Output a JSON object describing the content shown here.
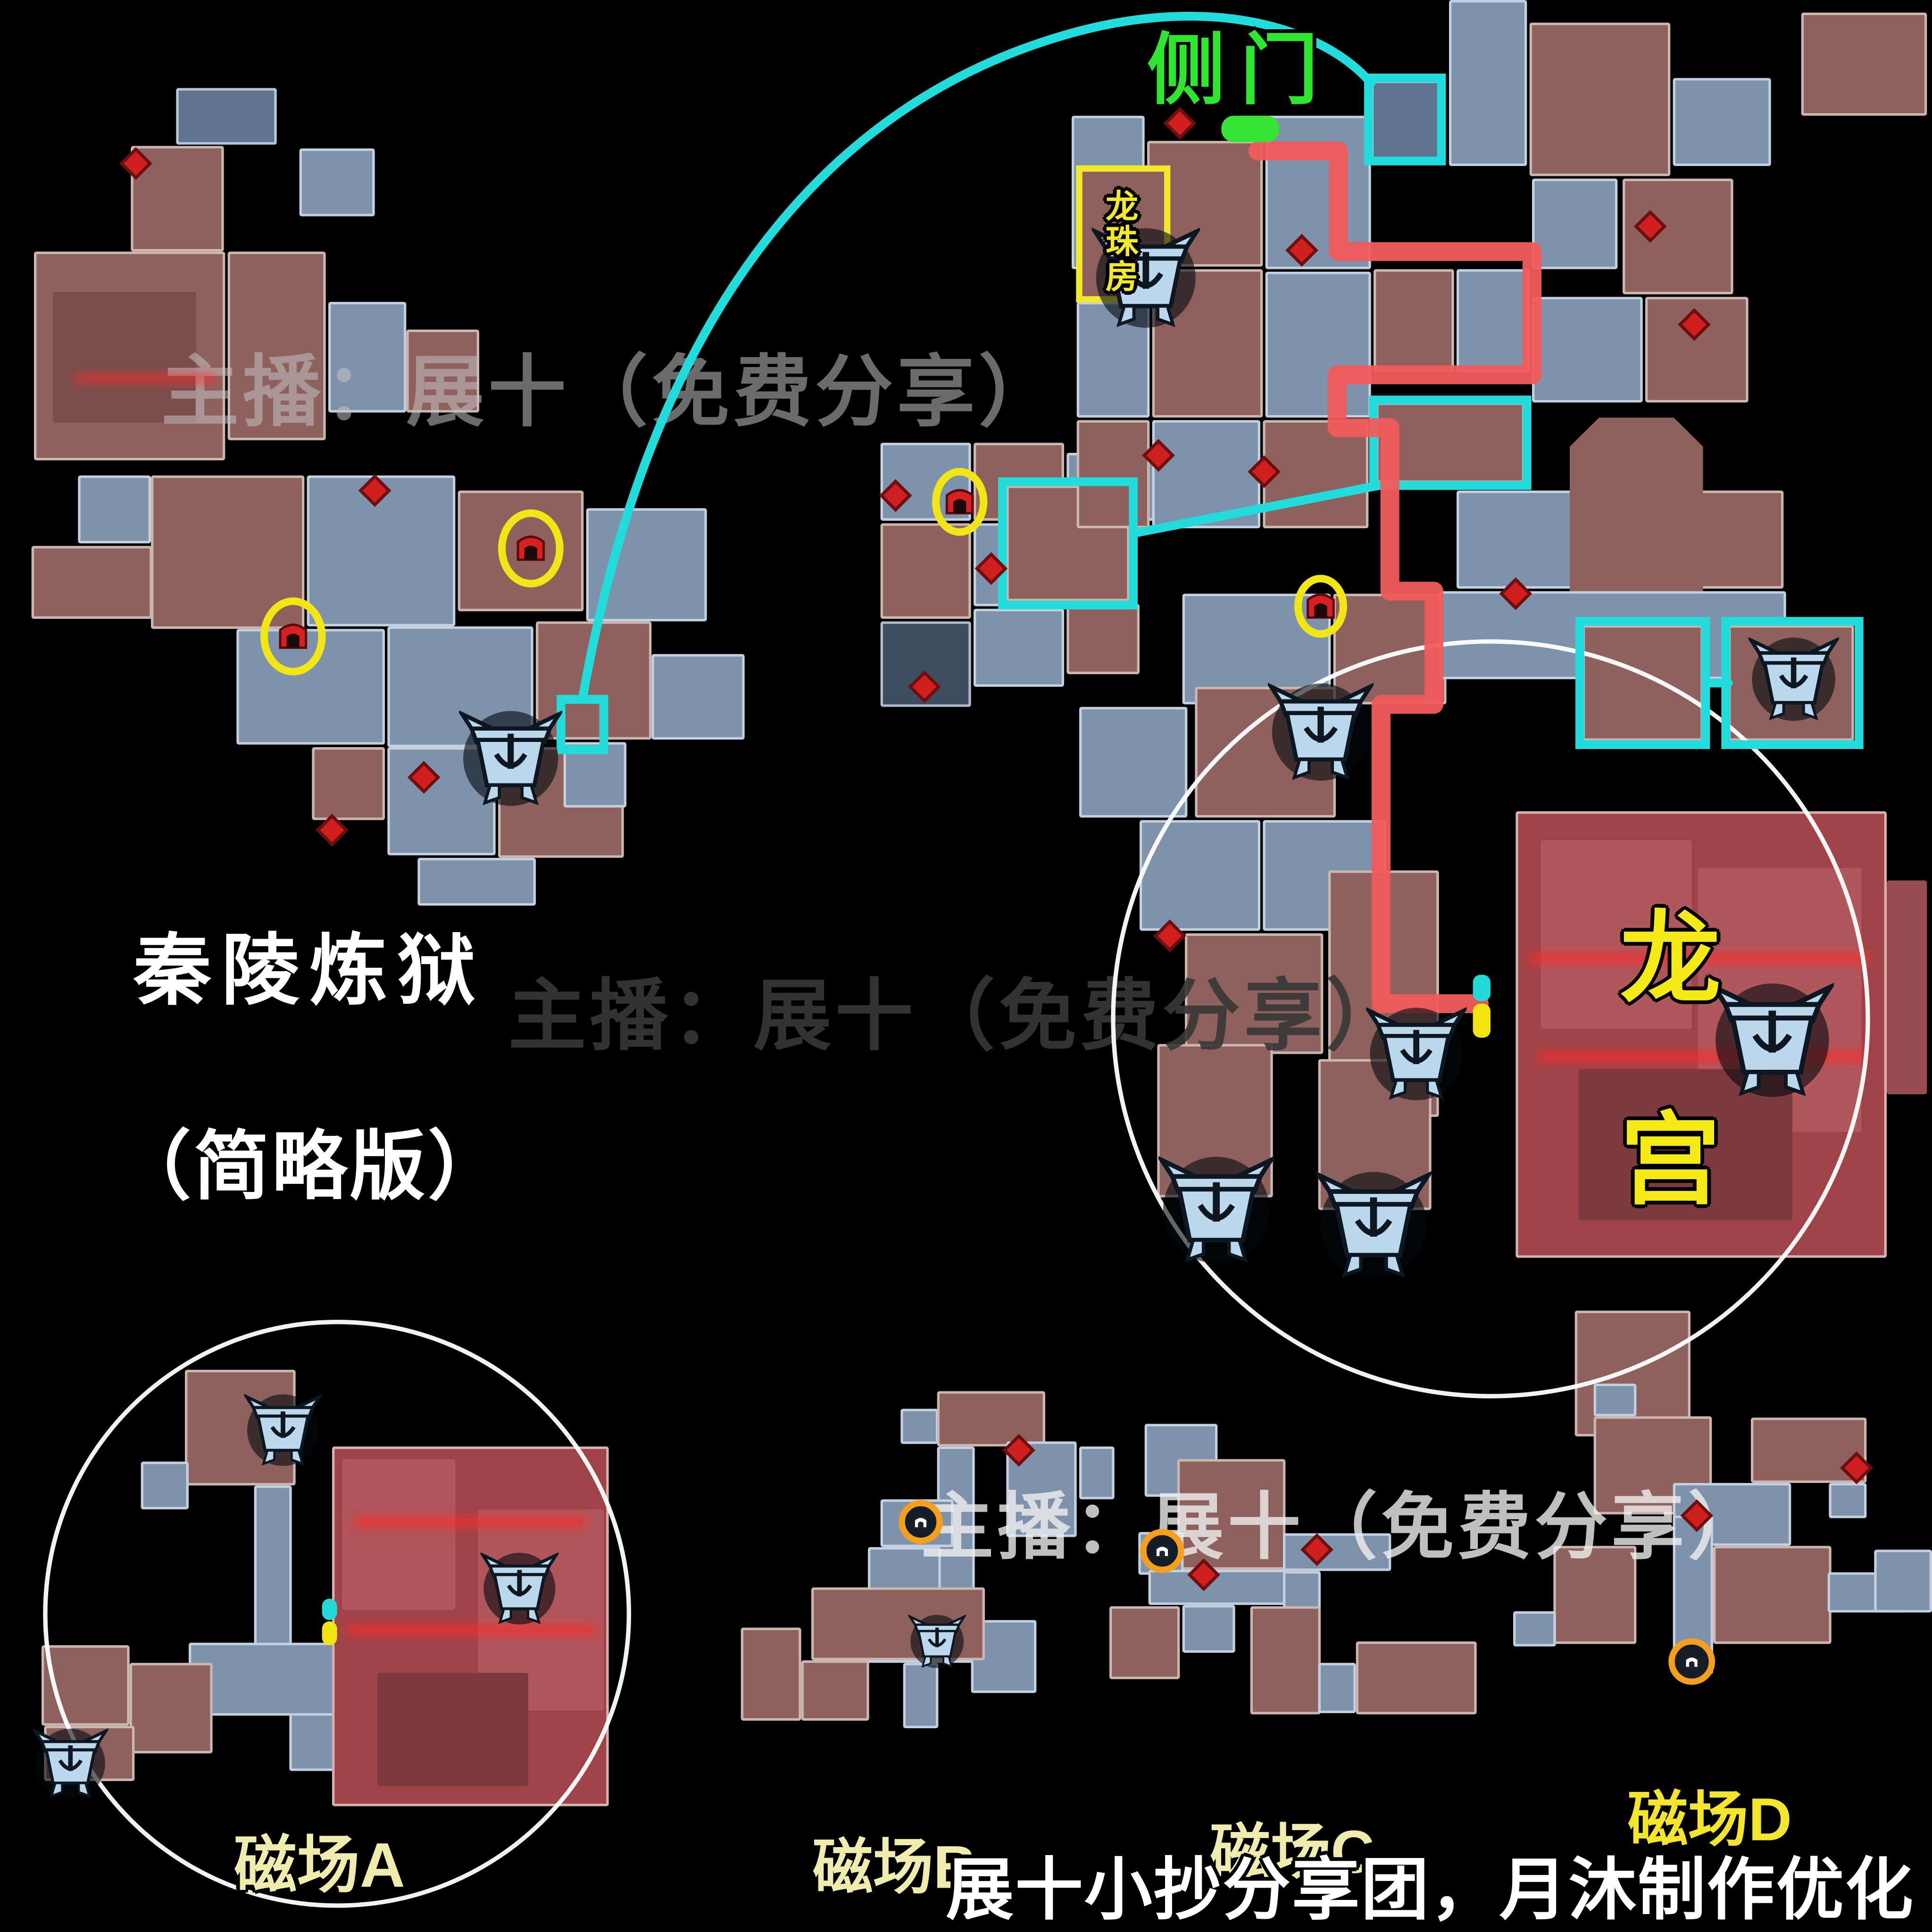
{
  "texts": {
    "watermark": "主播：展十（免费分享）",
    "side_door": "侧门",
    "pearl_room": [
      "龙",
      "珠",
      "房"
    ],
    "palace": [
      "龙",
      "宫"
    ],
    "title_line1": "秦陵炼狱",
    "title_line2": "（简略版）",
    "field_a": "磁场A",
    "field_b": "磁场B",
    "field_c": "磁场C",
    "field_d": "磁场D",
    "credit": "展十小抄分享团，月沐制作优化"
  },
  "colors": {
    "background": "#000000",
    "room_blue": "#7e92ac",
    "room_blue_dark": "#5f7490",
    "room_navy": "#3d4c60",
    "room_maroon": "#8e615f",
    "room_red": "#9e4449",
    "route_red": "#f15b5b",
    "cyan": "#22dcdc",
    "yellow": "#f2e616",
    "green": "#35e435",
    "orange": "#f59f1c",
    "label_cream": "#f0ecae",
    "label_yellow": "#f3e52c",
    "chest_fill": "#bcd8ec",
    "diamond_red": "#cf1f1f",
    "white": "#ffffff"
  },
  "map": {
    "rooms": [
      [
        140,
        70,
        80,
        45,
        "d"
      ],
      [
        104,
        116,
        74,
        84,
        "m"
      ],
      [
        238,
        118,
        60,
        54,
        "b"
      ],
      [
        27,
        200,
        152,
        166,
        "m"
      ],
      [
        42,
        232,
        114,
        104,
        "m2"
      ],
      [
        181,
        200,
        78,
        150,
        "m"
      ],
      [
        261,
        240,
        62,
        88,
        "b"
      ],
      [
        323,
        262,
        58,
        66,
        "m"
      ],
      [
        62,
        378,
        58,
        54,
        "b"
      ],
      [
        25,
        434,
        96,
        58,
        "m"
      ],
      [
        120,
        378,
        122,
        122,
        "m"
      ],
      [
        244,
        378,
        118,
        120,
        "b"
      ],
      [
        364,
        390,
        100,
        96,
        "m"
      ],
      [
        466,
        404,
        96,
        90,
        "b"
      ],
      [
        188,
        500,
        118,
        92,
        "b"
      ],
      [
        308,
        498,
        116,
        96,
        "b"
      ],
      [
        426,
        494,
        92,
        94,
        "m"
      ],
      [
        518,
        520,
        74,
        68,
        "b"
      ],
      [
        248,
        594,
        58,
        58,
        "m"
      ],
      [
        308,
        594,
        86,
        86,
        "b"
      ],
      [
        396,
        594,
        100,
        88,
        "m"
      ],
      [
        448,
        590,
        50,
        52,
        "b"
      ],
      [
        332,
        682,
        94,
        38,
        "b"
      ],
      [
        700,
        352,
        72,
        62,
        "b"
      ],
      [
        774,
        352,
        72,
        62,
        "m"
      ],
      [
        700,
        416,
        72,
        76,
        "m"
      ],
      [
        774,
        416,
        72,
        66,
        "b"
      ],
      [
        848,
        360,
        70,
        54,
        "b"
      ],
      [
        700,
        494,
        72,
        68,
        "k"
      ],
      [
        774,
        484,
        72,
        62,
        "b"
      ],
      [
        848,
        480,
        58,
        56,
        "m"
      ],
      [
        800,
        386,
        98,
        92,
        "m"
      ],
      [
        852,
        92,
        58,
        122,
        "b"
      ],
      [
        912,
        112,
        92,
        100,
        "m"
      ],
      [
        1006,
        92,
        84,
        122,
        "b"
      ],
      [
        1090,
        64,
        58,
        64,
        "d"
      ],
      [
        1152,
        0,
        62,
        132,
        "b"
      ],
      [
        1216,
        18,
        112,
        122,
        "m"
      ],
      [
        1330,
        62,
        78,
        70,
        "b"
      ],
      [
        1432,
        10,
        100,
        82,
        "m"
      ],
      [
        858,
        134,
        70,
        104,
        "m"
      ],
      [
        856,
        240,
        58,
        92,
        "b"
      ],
      [
        916,
        214,
        88,
        118,
        "m"
      ],
      [
        1006,
        216,
        84,
        116,
        "b"
      ],
      [
        1092,
        214,
        64,
        82,
        "m"
      ],
      [
        1158,
        214,
        58,
        82,
        "b"
      ],
      [
        1218,
        142,
        68,
        72,
        "b"
      ],
      [
        1290,
        142,
        88,
        92,
        "m"
      ],
      [
        1218,
        236,
        88,
        84,
        "b"
      ],
      [
        1308,
        236,
        82,
        84,
        "m"
      ],
      [
        1094,
        320,
        118,
        64,
        "m"
      ],
      [
        856,
        334,
        58,
        86,
        "m"
      ],
      [
        916,
        334,
        86,
        86,
        "b"
      ],
      [
        1004,
        334,
        84,
        86,
        "m"
      ],
      [
        1158,
        390,
        92,
        78,
        "b"
      ],
      [
        1300,
        390,
        118,
        78,
        "m"
      ],
      [
        1248,
        332,
        106,
        210,
        "m",
        "oct"
      ],
      [
        940,
        472,
        118,
        88,
        "b"
      ],
      [
        1060,
        472,
        90,
        88,
        "m"
      ],
      [
        1144,
        470,
        276,
        70,
        "b"
      ],
      [
        1258,
        497,
        96,
        92,
        "m"
      ],
      [
        1374,
        497,
        100,
        92,
        "m"
      ],
      [
        858,
        562,
        86,
        88,
        "b"
      ],
      [
        950,
        546,
        112,
        104,
        "m"
      ],
      [
        906,
        652,
        96,
        88,
        "b"
      ],
      [
        1004,
        652,
        98,
        88,
        "b"
      ],
      [
        942,
        742,
        110,
        96,
        "m"
      ],
      [
        1056,
        692,
        88,
        196,
        "m"
      ],
      [
        920,
        830,
        92,
        122,
        "m"
      ],
      [
        1048,
        842,
        90,
        120,
        "m"
      ],
      [
        1205,
        645,
        295,
        355,
        "r"
      ],
      [
        1225,
        668,
        120,
        150,
        "r2"
      ],
      [
        1350,
        690,
        130,
        210,
        "r2"
      ],
      [
        1255,
        850,
        170,
        120,
        "r3"
      ],
      [
        1500,
        700,
        32,
        170,
        "r2"
      ],
      [
        1252,
        1042,
        92,
        100,
        "m"
      ],
      [
        147,
        1089,
        88,
        92,
        "m"
      ],
      [
        112,
        1162,
        38,
        38,
        "b"
      ],
      [
        202,
        1181,
        30,
        128,
        "b"
      ],
      [
        150,
        1306,
        120,
        58,
        "b"
      ],
      [
        230,
        1362,
        62,
        46,
        "b"
      ],
      [
        33,
        1308,
        70,
        64,
        "m"
      ],
      [
        103,
        1322,
        66,
        72,
        "m"
      ],
      [
        35,
        1372,
        72,
        44,
        "m"
      ],
      [
        264,
        1150,
        220,
        286,
        "r"
      ],
      [
        272,
        1160,
        90,
        120,
        "r2"
      ],
      [
        380,
        1200,
        100,
        160,
        "r2"
      ],
      [
        300,
        1330,
        120,
        90,
        "r3"
      ],
      [
        716,
        1120,
        30,
        28,
        "b"
      ],
      [
        745,
        1106,
        86,
        44,
        "m"
      ],
      [
        745,
        1150,
        30,
        146,
        "b"
      ],
      [
        800,
        1146,
        56,
        76,
        "b"
      ],
      [
        858,
        1150,
        28,
        42,
        "b"
      ],
      [
        700,
        1192,
        58,
        38,
        "b"
      ],
      [
        690,
        1230,
        58,
        58,
        "b"
      ],
      [
        688,
        1288,
        96,
        34,
        "b"
      ],
      [
        718,
        1322,
        28,
        52,
        "b"
      ],
      [
        772,
        1288,
        52,
        58,
        "b"
      ],
      [
        589,
        1294,
        48,
        74,
        "m"
      ],
      [
        637,
        1320,
        54,
        48,
        "m"
      ],
      [
        645,
        1262,
        138,
        58,
        "m"
      ],
      [
        910,
        1132,
        58,
        58,
        "b"
      ],
      [
        936,
        1160,
        86,
        88,
        "m"
      ],
      [
        905,
        1218,
        36,
        34,
        "b"
      ],
      [
        1020,
        1219,
        86,
        30,
        "b"
      ],
      [
        913,
        1248,
        110,
        28,
        "b"
      ],
      [
        940,
        1276,
        42,
        38,
        "b"
      ],
      [
        1020,
        1249,
        30,
        58,
        "b"
      ],
      [
        882,
        1277,
        56,
        58,
        "m"
      ],
      [
        994,
        1277,
        56,
        86,
        "m"
      ],
      [
        1078,
        1305,
        96,
        58,
        "m"
      ],
      [
        1048,
        1322,
        30,
        40,
        "b"
      ],
      [
        1267,
        1100,
        34,
        26,
        "b"
      ],
      [
        1267,
        1126,
        94,
        78,
        "m"
      ],
      [
        1392,
        1127,
        92,
        52,
        "m"
      ],
      [
        1454,
        1179,
        30,
        28,
        "b"
      ],
      [
        1330,
        1179,
        94,
        50,
        "b"
      ],
      [
        1235,
        1229,
        66,
        78,
        "m"
      ],
      [
        1330,
        1205,
        32,
        126,
        "b"
      ],
      [
        1362,
        1229,
        94,
        78,
        "m"
      ],
      [
        1453,
        1250,
        64,
        32,
        "b"
      ],
      [
        1203,
        1281,
        34,
        28,
        "b"
      ],
      [
        1490,
        1232,
        46,
        50,
        "b"
      ]
    ],
    "glows": [
      [
        1215,
        758,
        272,
        8
      ],
      [
        1222,
        836,
        262,
        8
      ],
      [
        282,
        1206,
        184,
        8
      ],
      [
        276,
        1292,
        198,
        8
      ],
      [
        60,
        298,
        112,
        6
      ]
    ],
    "chests": [
      [
        365,
        562,
        82
      ],
      [
        868,
        178,
        86
      ],
      [
        1008,
        540,
        84
      ],
      [
        1086,
        798,
        80
      ],
      [
        921,
        916,
        92
      ],
      [
        1046,
        928,
        92
      ],
      [
        1360,
        778,
        98
      ],
      [
        1390,
        504,
        72
      ],
      [
        194,
        1106,
        62
      ],
      [
        382,
        1232,
        62
      ],
      [
        26,
        1372,
        60
      ],
      [
        722,
        1282,
        46
      ]
    ],
    "diamonds": [
      [
        108,
        130
      ],
      [
        298,
        390
      ],
      [
        337,
        618
      ],
      [
        264,
        660
      ],
      [
        712,
        394
      ],
      [
        788,
        452
      ],
      [
        735,
        546
      ],
      [
        938,
        98
      ],
      [
        1035,
        199
      ],
      [
        921,
        362
      ],
      [
        1005,
        375
      ],
      [
        1312,
        180
      ],
      [
        1347,
        258
      ],
      [
        1205,
        472
      ],
      [
        930,
        744
      ],
      [
        810,
        1153
      ],
      [
        1047,
        1232
      ],
      [
        957,
        1252
      ],
      [
        1476,
        1167
      ],
      [
        1349,
        1205
      ]
    ],
    "gate_items": [
      [
        422,
        436
      ],
      [
        233,
        506
      ],
      [
        763,
        399
      ],
      [
        1050,
        482
      ]
    ],
    "yellow_circles": [
      [
        422,
        436,
        23,
        28
      ],
      [
        233,
        506,
        23,
        28
      ],
      [
        763,
        399,
        19,
        24
      ],
      [
        1050,
        482,
        18,
        22
      ]
    ],
    "orange_circles": [
      [
        732,
        1210,
        15
      ],
      [
        924,
        1233,
        15
      ],
      [
        1345,
        1321,
        16
      ]
    ],
    "white_circles": [
      [
        1185,
        810,
        300
      ],
      [
        268,
        1283,
        232
      ]
    ],
    "cyan_rects": [
      [
        446,
        556,
        34,
        40
      ],
      [
        1088,
        62,
        58,
        66
      ],
      [
        797,
        383,
        104,
        98
      ],
      [
        1092,
        318,
        122,
        68
      ],
      [
        1256,
        494,
        100,
        98
      ],
      [
        1372,
        494,
        106,
        98
      ]
    ],
    "yellow_rects": [
      [
        858,
        134,
        70,
        104
      ]
    ],
    "cyan_lines": [
      "M463,556 C505,318 612,96 846,28 C962,-6 1052,22 1090,66",
      "M901,424 L1096,386",
      "M1356,543 L1374,543"
    ],
    "red_route": "1000,120 1064,120 1064,200 1218,200 1218,298 1063,298 1063,340 1105,340 1105,470 1140,470 1140,560 1098,560 1098,798 1176,798",
    "green_marker": [
      971,
      92,
      46,
      21
    ],
    "ticks": [
      [
        1171,
        775,
        14,
        21,
        "cyan"
      ],
      [
        1171,
        798,
        14,
        27,
        "yellow"
      ],
      [
        256,
        1271,
        12,
        17,
        "cyan"
      ],
      [
        256,
        1289,
        12,
        19,
        "yellow"
      ]
    ]
  }
}
